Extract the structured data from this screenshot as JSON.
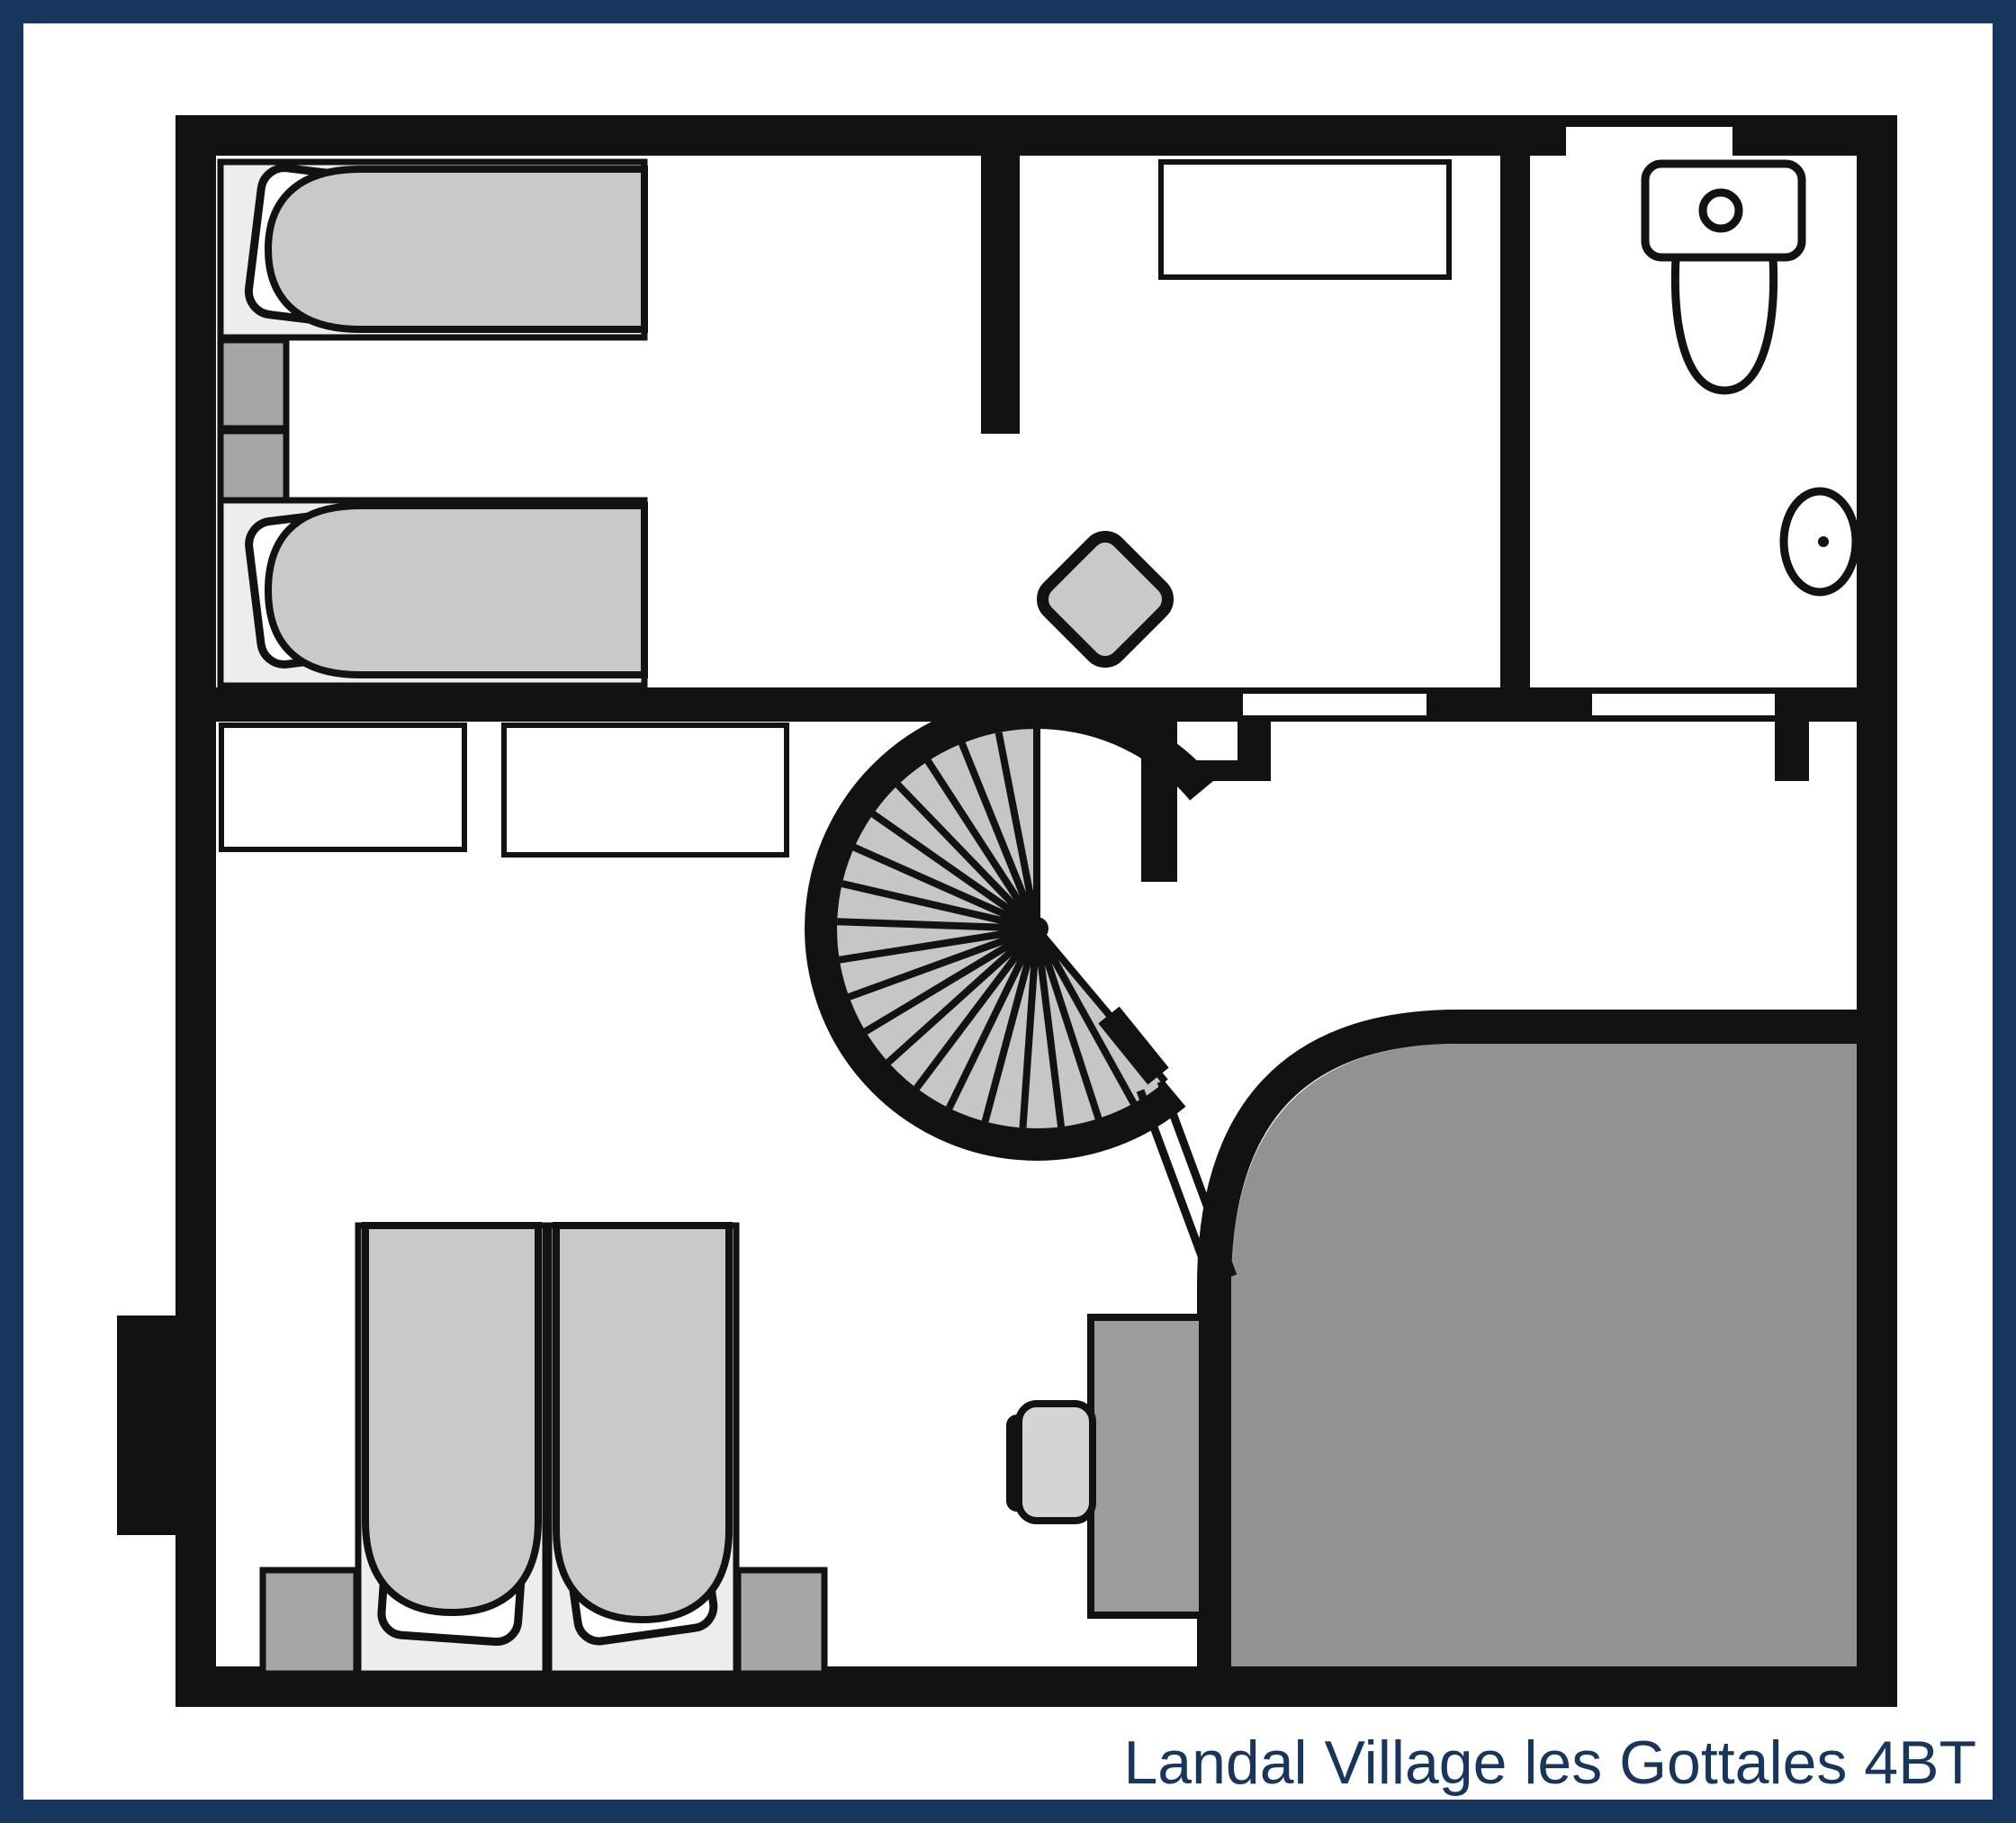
{
  "caption": {
    "text": "Landal Village les Gottales 4BT"
  },
  "colors": {
    "navy": "#17365d",
    "wall": "#121212",
    "paper": "#ffffff",
    "mattress": "#c9c9c9",
    "bed-base": "#ededed",
    "nightstand": "#a6a6a6",
    "steps": "#c6c6c6",
    "void": "#929292",
    "desk": "#9c9c9c",
    "chair": "#d4d4d4",
    "table": "#c9c9c9"
  },
  "floorplan": {
    "label": "Landal Village les Gottales 4BT",
    "rooms": [
      {
        "name": "bedroom-top-left"
      },
      {
        "name": "hallway"
      },
      {
        "name": "bathroom"
      },
      {
        "name": "bedroom-bottom-left"
      },
      {
        "name": "stair-landing"
      },
      {
        "name": "void-open-below"
      }
    ],
    "furniture": [
      "single-bed",
      "single-bed",
      "nightstand",
      "nightstand",
      "sideboard",
      "side-table",
      "toilet",
      "washbasin",
      "spiral-staircase",
      "wardrobe",
      "wardrobe",
      "single-bed",
      "single-bed",
      "nightstand",
      "nightstand",
      "desk",
      "chair"
    ]
  }
}
